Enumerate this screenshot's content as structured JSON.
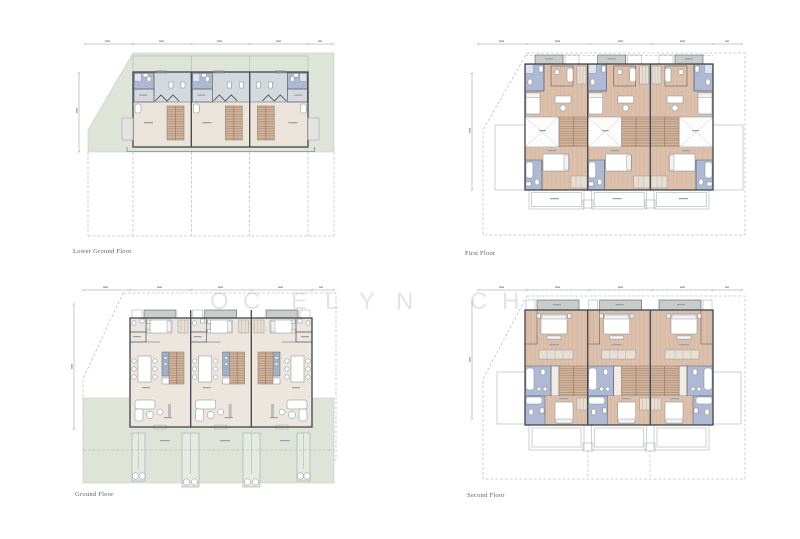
{
  "plans": [
    {
      "id": "lower-ground-floor",
      "label": "Lower Ground Floor"
    },
    {
      "id": "first-floor",
      "label": "First Floor"
    },
    {
      "id": "ground-floor",
      "label": "Ground Floor"
    },
    {
      "id": "second-floor",
      "label": "Second Floor"
    }
  ],
  "watermark": {
    "letters": [
      "O",
      "C",
      "E",
      "L",
      "Y",
      "N",
      "C",
      "H"
    ]
  },
  "palette": {
    "background": "#ffffff",
    "site_green": "#dee5d8",
    "floor_beige": "#eae4db",
    "upper_band_gray": "#d3d9dd",
    "bathroom_lavender": "#aeb9d3",
    "wood_floor": "#d9bba4",
    "stair_wood": "#d3b49b",
    "balcony_gray": "#c6cdcc",
    "wall_dark": "#40454c",
    "boundary_dash_gray": "#a0a5aa",
    "label_gray": "#5d6167"
  }
}
